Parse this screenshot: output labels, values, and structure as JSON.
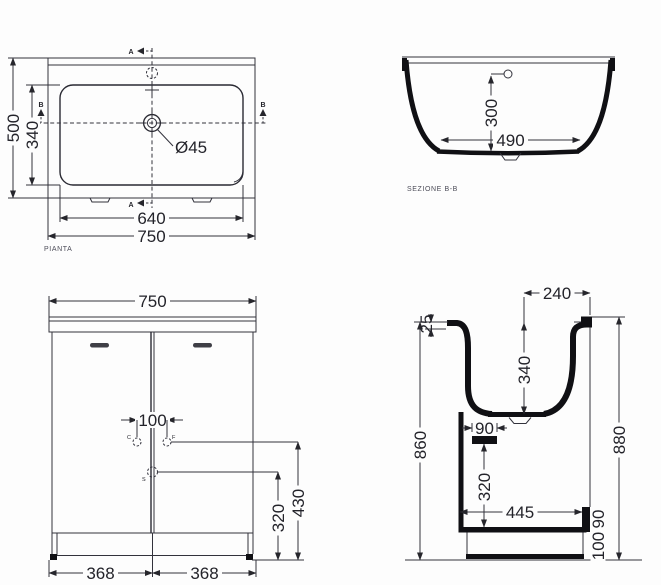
{
  "drawing": {
    "background_color": "#fdfdfd",
    "thin_line_color": "#32323c",
    "heavy_line_color": "#101014",
    "text_color": "#23232a",
    "label_color": "#4c4c58"
  },
  "plan": {
    "label": "PIANTA",
    "section_marker_a": "A",
    "section_marker_b": "B",
    "dim_overall_width": "750",
    "dim_basin_width": "640",
    "dim_overall_depth": "500",
    "dim_basin_depth": "340",
    "dim_drain_diameter": "Ø45"
  },
  "section_bb": {
    "label": "SEZIONE B-B",
    "dim_basin_width": "490",
    "dim_basin_depth": "300"
  },
  "front": {
    "dim_overall_width": "750",
    "dim_door_left": "368",
    "dim_door_right": "368",
    "dim_hole_spacing": "100",
    "dim_drain_height": "320",
    "dim_hole_height": "430",
    "marker_c": "C",
    "marker_f": "F",
    "marker_s": "S"
  },
  "side": {
    "dim_rim_to_front": "240",
    "dim_rim_thickness": "25",
    "dim_basin_depth": "340",
    "dim_drain_width": "90",
    "dim_height_back": "860",
    "dim_height_overall": "880",
    "dim_drain_height": "320",
    "dim_base_depth": "445",
    "dim_step_height": "90",
    "dim_plinth_height": "100"
  }
}
